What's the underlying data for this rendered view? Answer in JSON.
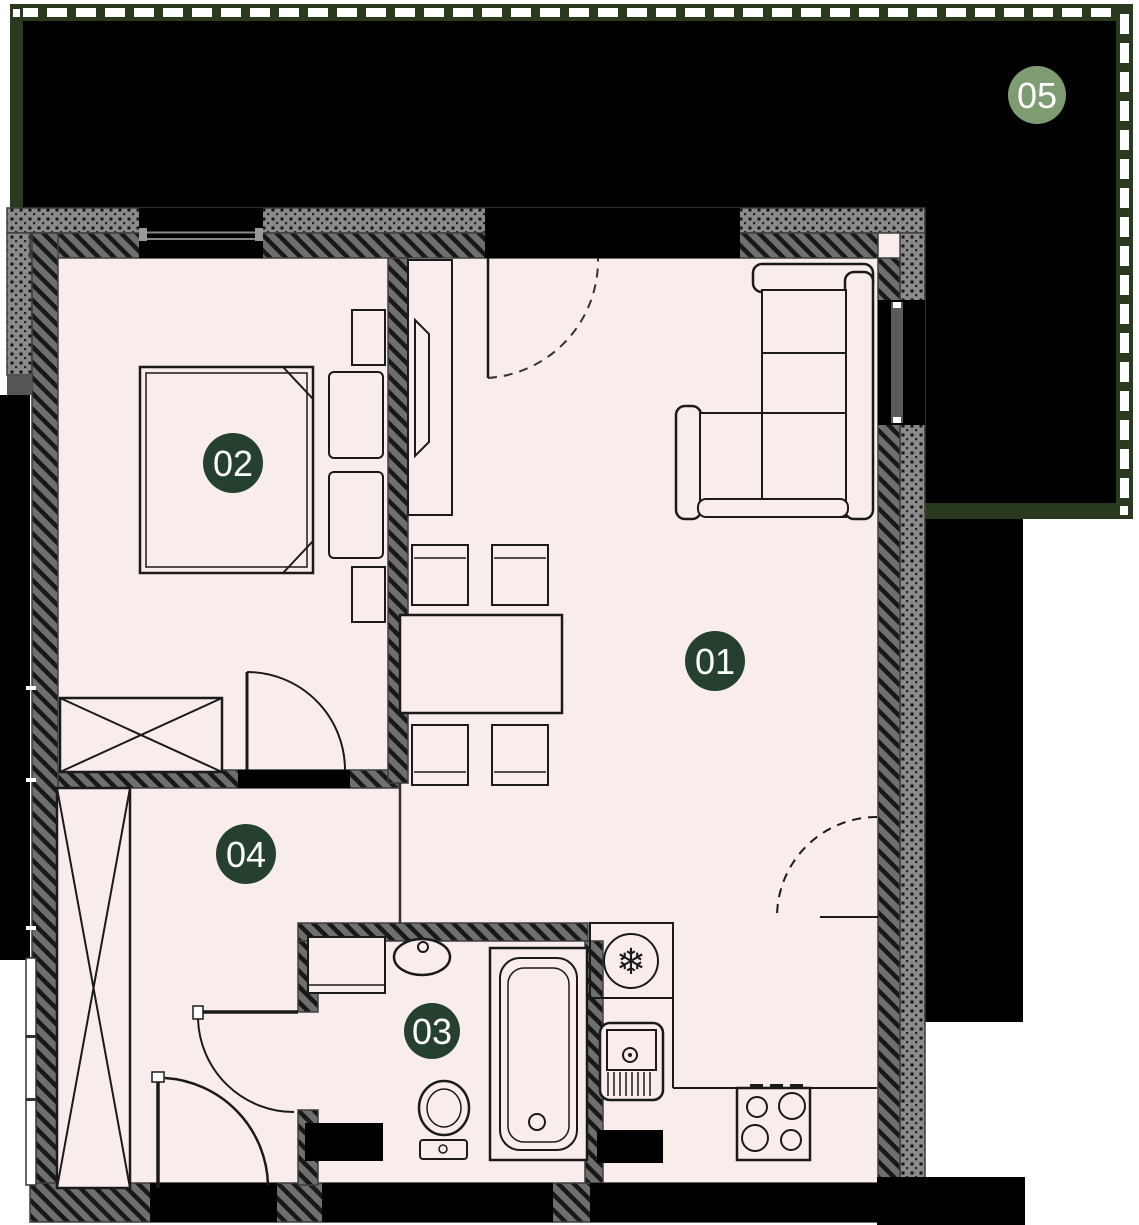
{
  "floorplan": {
    "unit_labels": [
      {
        "id": "room-01",
        "label": "01"
      },
      {
        "id": "room-02",
        "label": "02"
      },
      {
        "id": "room-03",
        "label": "03"
      },
      {
        "id": "room-04",
        "label": "04"
      },
      {
        "id": "terrace-05",
        "label": "05"
      }
    ],
    "colors": {
      "floor_fill": "#f9edeb",
      "room_label_bg": "#26402f",
      "terrace_label_bg": "#7e9c71",
      "label_text": "#ffffff",
      "terrace_fill": "#000000",
      "railing_green": "#2a3a1e",
      "railing_dash": "#ffffff",
      "wall_diag_base": "#6f6f6f",
      "wall_dot_base": "#8b8b8b",
      "outline_dark": "#1a1a1a"
    },
    "icons": {
      "fridge_snowflake": "❄"
    }
  }
}
